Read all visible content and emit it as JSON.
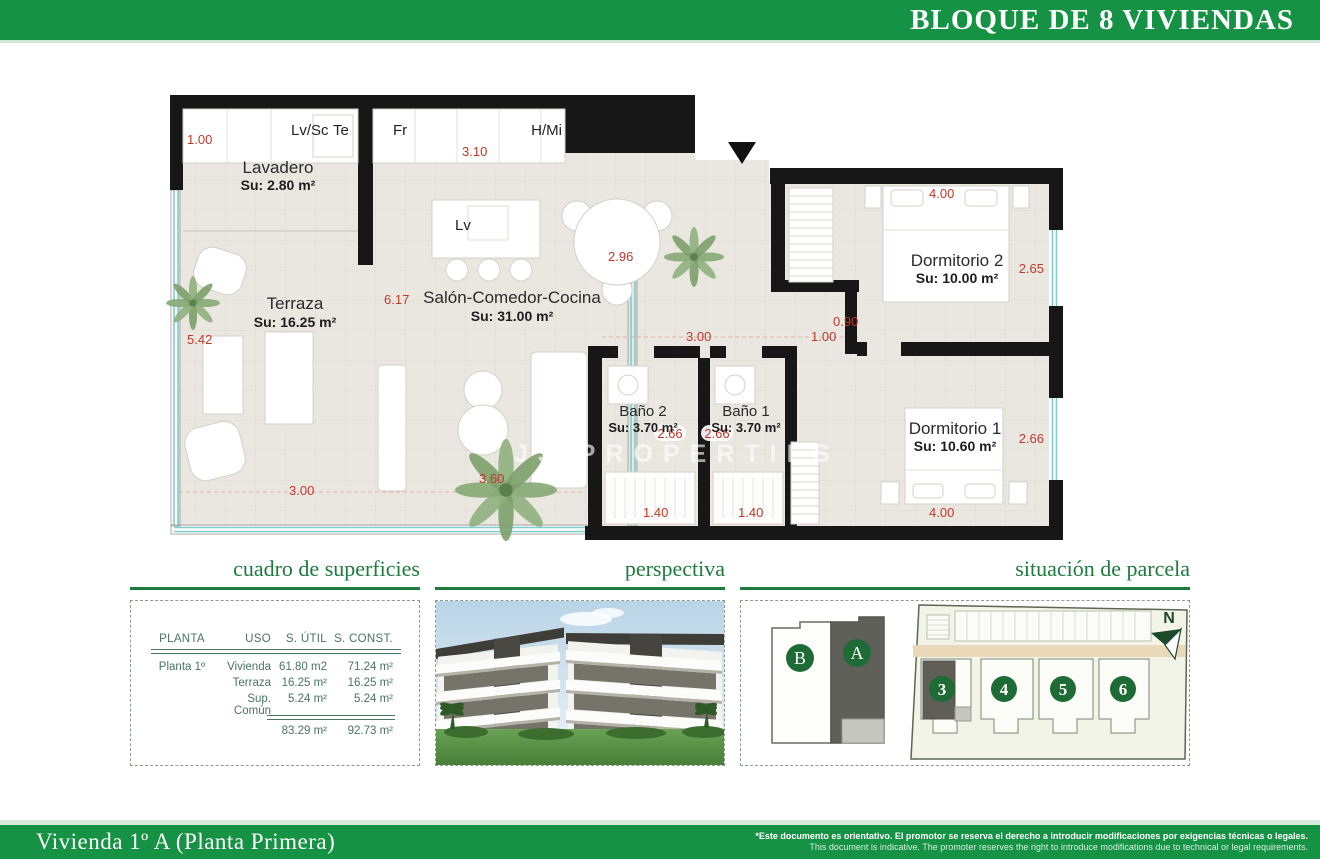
{
  "colors": {
    "banner_green": "#169245",
    "section_green": "#1d7b3e",
    "dimension_red": "#c0392b",
    "table_green": "#4a7560",
    "highlight_unit_grey": "#60605a",
    "window_teal": "#7fccd2"
  },
  "header": {
    "title": "BLOQUE DE 8 VIVIENDAS"
  },
  "plan": {
    "watermark": "JJ PROPERTIES",
    "fixtures": {
      "lvsc": "Lv/Sc",
      "te": "Te",
      "fr": "Fr",
      "hmi": "H/Mi",
      "lv": "Lv"
    },
    "rooms": {
      "lavadero": {
        "name": "Lavadero",
        "area": "Su: 2.80 m²"
      },
      "terraza": {
        "name": "Terraza",
        "area": "Su: 16.25 m²"
      },
      "salon": {
        "name": "Salón-Comedor-Cocina",
        "area": "Su: 31.00 m²"
      },
      "banyo2": {
        "name": "Baño 2",
        "area": "Su: 3.70 m²"
      },
      "banyo1": {
        "name": "Baño 1",
        "area": "Su: 3.70 m²"
      },
      "dorm2": {
        "name": "Dormitorio 2",
        "area": "Su: 10.00 m²"
      },
      "dorm1": {
        "name": "Dormitorio 1",
        "area": "Su: 10.60 m²"
      }
    },
    "dims": {
      "lavadero_w": "1.00",
      "cocina_w": "3.10",
      "salon_mesa": "2.96",
      "salon_h": "6.17",
      "terraza_h": "5.42",
      "terraza_w": "3.00",
      "salon_w": "3.60",
      "hall_w": "3.00",
      "hall_d": "1.00",
      "hall_s": "0.90",
      "dorm2_w": "4.00",
      "dorm2_h": "2.65",
      "banyo2_h": "2.66",
      "banyo1_h": "2.66",
      "dorm1_h": "2.66",
      "banyo2_w": "1.40",
      "banyo1_w": "1.40",
      "dorm1_w": "4.00"
    }
  },
  "sections": {
    "superficies": {
      "title": "cuadro de superficies",
      "table": {
        "headers": [
          "PLANTA",
          "USO",
          "S. ÚTIL",
          "S. CONST."
        ],
        "rows": [
          [
            "Planta 1º",
            "Vivienda",
            "61.80 m2",
            "71.24 m²"
          ],
          [
            "",
            "Terraza",
            "16.25 m²",
            "16.25 m²"
          ],
          [
            "",
            "Sup. Común",
            "5.24 m²",
            "5.24 m²"
          ]
        ],
        "totals": [
          "83.29 m²",
          "92.73 m²"
        ]
      }
    },
    "perspectiva": {
      "title": "perspectiva"
    },
    "parcela": {
      "title": "situación de parcela",
      "north": "N",
      "units": [
        {
          "label": "B"
        },
        {
          "label": "A"
        }
      ],
      "plots": [
        {
          "label": "3"
        },
        {
          "label": "4"
        },
        {
          "label": "5"
        },
        {
          "label": "6"
        }
      ]
    }
  },
  "footer": {
    "title": "Vivienda 1º A (Planta Primera)",
    "disclaimer_es": "*Este documento es orientativo. El promotor se reserva el derecho a introducir modificaciones por exigencias técnicas o legales.",
    "disclaimer_en": "This document is indicative. The promoter reserves the right to introduce modifications due to technical or legal requirements."
  }
}
